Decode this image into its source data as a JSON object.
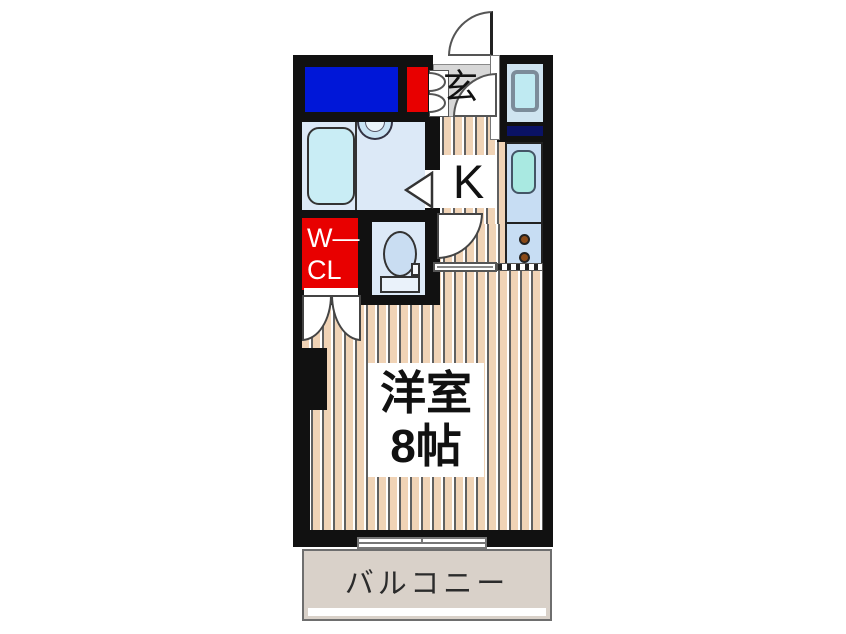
{
  "floorplan": {
    "entrance": {
      "label": "玄"
    },
    "kitchen": {
      "label": "K"
    },
    "walk_in_closet": {
      "label_line1": "W―",
      "label_line2": "CL"
    },
    "main_room": {
      "name": "洋室",
      "size": "8帖"
    },
    "balcony": {
      "label": "バルコニー"
    },
    "colors": {
      "wall": "#111111",
      "storage_blue": "#0017d8",
      "accent_red": "#e80000",
      "wood_floor": "#f0d3b6",
      "entrance_tile": "#d7d7d7",
      "bathroom_floor": "#dce9f7",
      "fixture_blue": "#c9edf5",
      "sink_teal": "#a9e9e1",
      "counter_blue": "#c7ddf3",
      "navy_strip": "#0a1265",
      "burner_brown": "#8a4a18",
      "balcony_gray": "#d9d1c9"
    }
  }
}
